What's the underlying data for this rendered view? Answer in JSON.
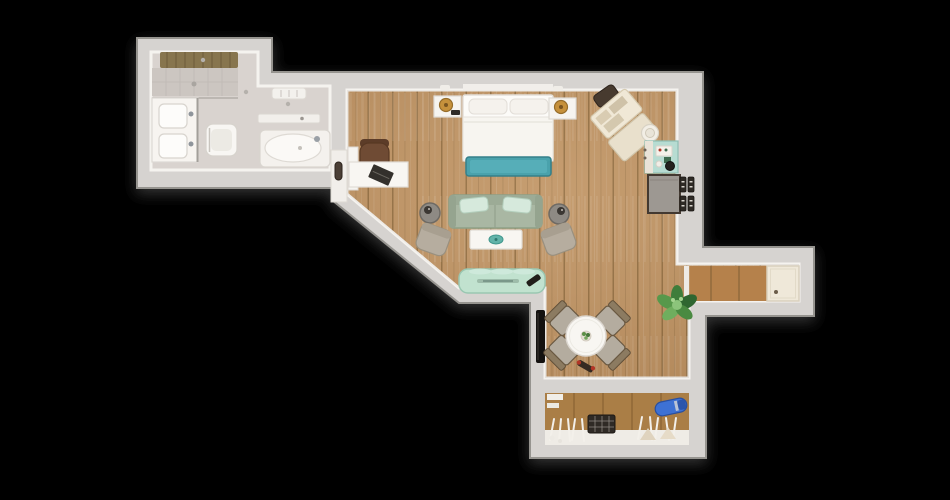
{
  "scene": {
    "title": "apartment-floor-plan-3d-top-view",
    "background": "#000000"
  },
  "colors": {
    "wall": "#d6d3d0",
    "wall_edge": "#96948f",
    "wall_inner_face": "#f5f3ef",
    "floor_wood": "#bf9260",
    "floor_wood_line": "#926c3d",
    "bath_floor": "#d9d3cf",
    "hall_wood": "#b5814b",
    "closet_wood": "#aa7e46",
    "accent_teal": "#4aa2ac",
    "accent_mint": "#c1e2cf",
    "kitchen_mint": "#b7dcd2",
    "sofa_sage": "#a9b7a3",
    "pillow_mint": "#d6e9dc",
    "armchair_beige": "#b6ad9f",
    "chair_greige": "#b4ac9f",
    "vacuum_blue": "#3d71d4",
    "lamp_gold": "#c6913c",
    "plant_green": "#57984b",
    "white_furniture": "#f8f6f2",
    "dark_item": "#2e2a25"
  },
  "rooms": [
    {
      "name": "bathroom",
      "objects": [
        "walk-in-shower",
        "shower-mat",
        "double-sink-vanity",
        "toilet",
        "bathtub",
        "wall-shelf",
        "ceiling-vent"
      ]
    },
    {
      "name": "bedroom-living-area",
      "objects": [
        "double-bed",
        "pillows",
        "nightstand-left",
        "nightstand-right",
        "table-lamps",
        "teal-bed-bench",
        "desk",
        "laptop",
        "office-chair",
        "sliding-door",
        "sofa",
        "mint-cushions",
        "armchair-left",
        "armchair-right",
        "side-tables",
        "coffee-table",
        "mint-console",
        "open-suitcase",
        "travel-bag",
        "hat"
      ]
    },
    {
      "name": "kitchenette",
      "objects": [
        "mint-minibar",
        "coffee-tray",
        "kettle",
        "gray-cabinet",
        "wall-panels"
      ]
    },
    {
      "name": "dining-area",
      "objects": [
        "round-dining-table",
        "dining-chairs-x4",
        "potted-plant",
        "floor-toy",
        "wall-niche"
      ]
    },
    {
      "name": "entry-hallway",
      "objects": [
        "tiled-floor",
        "entry-door",
        "threshold"
      ]
    },
    {
      "name": "walk-in-closet",
      "objects": [
        "clothes-rail",
        "hangers",
        "storage-basket",
        "vacuum-cleaner",
        "shelves"
      ]
    }
  ]
}
